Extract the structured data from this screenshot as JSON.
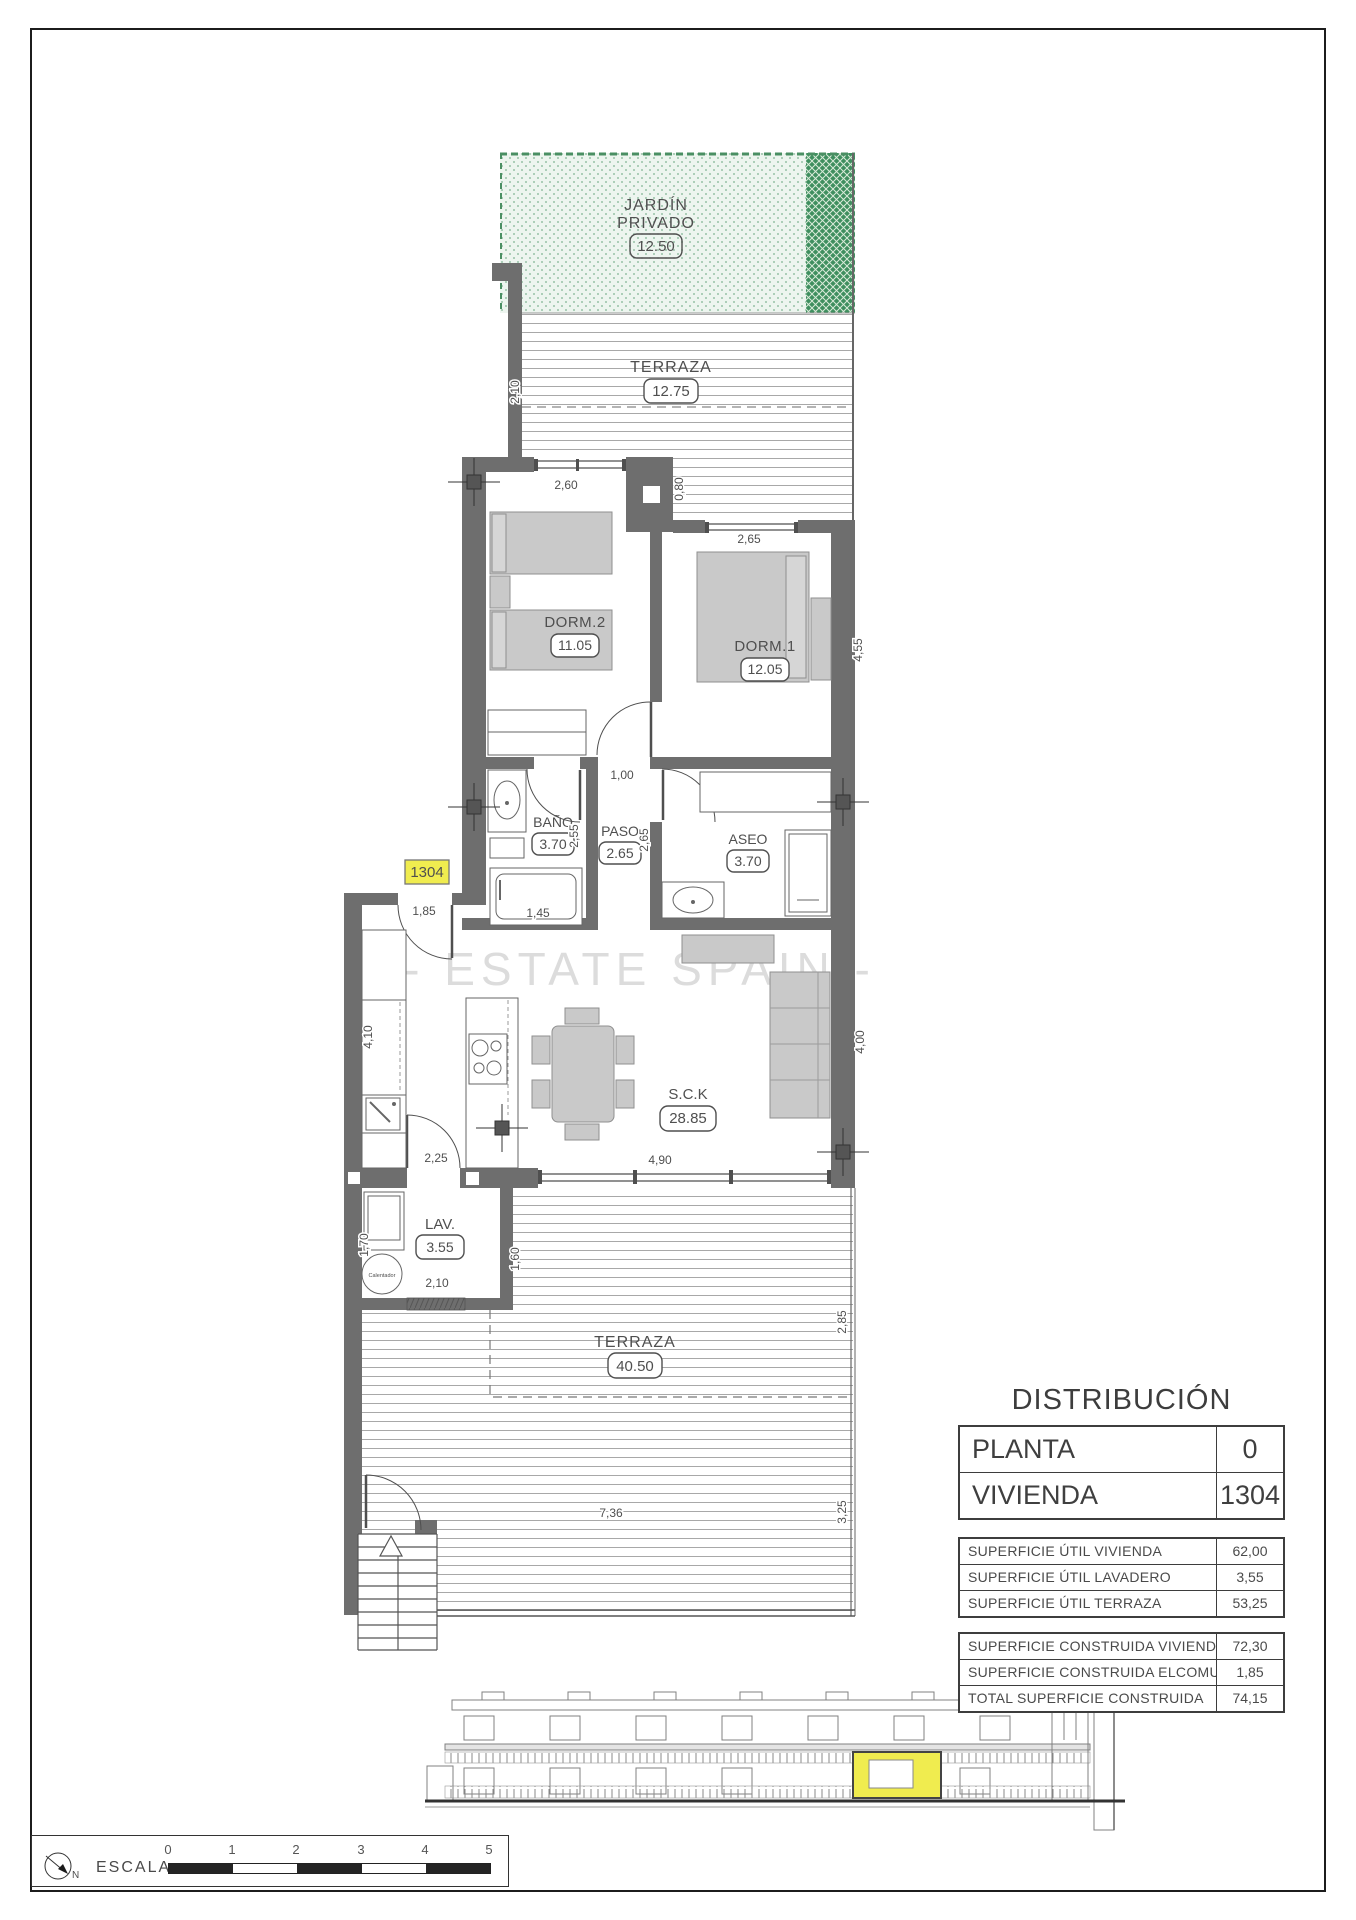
{
  "plan": {
    "watermark": "- ESTATE SPAIN -",
    "unit_badge": "1304",
    "rooms": {
      "jardin": {
        "name_line1": "JARDÍN",
        "name_line2": "PRIVADO",
        "area": "12.50"
      },
      "terraza_top": {
        "name": "TERRAZA",
        "area": "12.75"
      },
      "dorm2": {
        "name": "DORM.2",
        "area": "11.05"
      },
      "dorm1": {
        "name": "DORM.1",
        "area": "12.05"
      },
      "bano": {
        "name": "BAÑO",
        "area": "3.70"
      },
      "paso": {
        "name": "PASO",
        "area": "2.65"
      },
      "aseo": {
        "name": "ASEO",
        "area": "3.70"
      },
      "salon": {
        "name": "S.C.K",
        "area": "28.85"
      },
      "lavadero": {
        "name": "LAV.",
        "area": "3.55"
      },
      "terraza_bottom": {
        "name": "TERRAZA",
        "area": "40.50"
      }
    },
    "dims": {
      "terraza_top_depth": "2,10",
      "dorm2_window": "2,60",
      "terraza_step": "0,80",
      "dorm1_window": "2,65",
      "dorm1_depth": "4,55",
      "paso_width": "1,00",
      "bano_depth": "2,55",
      "paso_depth": "2,65",
      "bathtub": "1,45",
      "entry_door": "1,85",
      "kitchen_length": "4,10",
      "salon_depth": "4,00",
      "kitchen_door": "2,25",
      "salon_window": "4,90",
      "lav_left": "1,70",
      "lav_door": "2,10",
      "terraza_cover": "1,60",
      "terraza_right_a": "2,85",
      "terraza_length": "7,36",
      "terraza_right_b": "3,25"
    },
    "equipment": {
      "water_heater": "Calentador"
    }
  },
  "distribution": {
    "title": "DISTRIBUCIÓN",
    "unit_rows": [
      {
        "label": "PLANTA",
        "value": "0"
      },
      {
        "label": "VIVIENDA",
        "value": "1304"
      }
    ],
    "useful_rows": [
      {
        "label": "SUPERFICIE ÚTIL VIVIENDA",
        "value": "62,00"
      },
      {
        "label": "SUPERFICIE ÚTIL LAVADERO",
        "value": "3,55"
      },
      {
        "label": "SUPERFICIE ÚTIL TERRAZA",
        "value": "53,25"
      }
    ],
    "built_rows": [
      {
        "label": "SUPERFICIE CONSTRUIDA VIVIENDA",
        "value": "72,30"
      },
      {
        "label": "SUPERFICIE CONSTRUIDA ELCOMUNES",
        "value": "1,85"
      },
      {
        "label": "TOTAL SUPERFICIE CONSTRUIDA",
        "value": "74,15"
      }
    ]
  },
  "legend": {
    "escala_label": "ESCALA :",
    "north_label": "N",
    "ticks": [
      "0",
      "1",
      "2",
      "3",
      "4",
      "5"
    ]
  },
  "colors": {
    "wall": "#6e6e6e",
    "garden_light": "#edf5ef",
    "garden_dark": "#3f8f5f",
    "highlight_yellow": "#f0ec4f",
    "furniture": "#c9c9c9"
  }
}
